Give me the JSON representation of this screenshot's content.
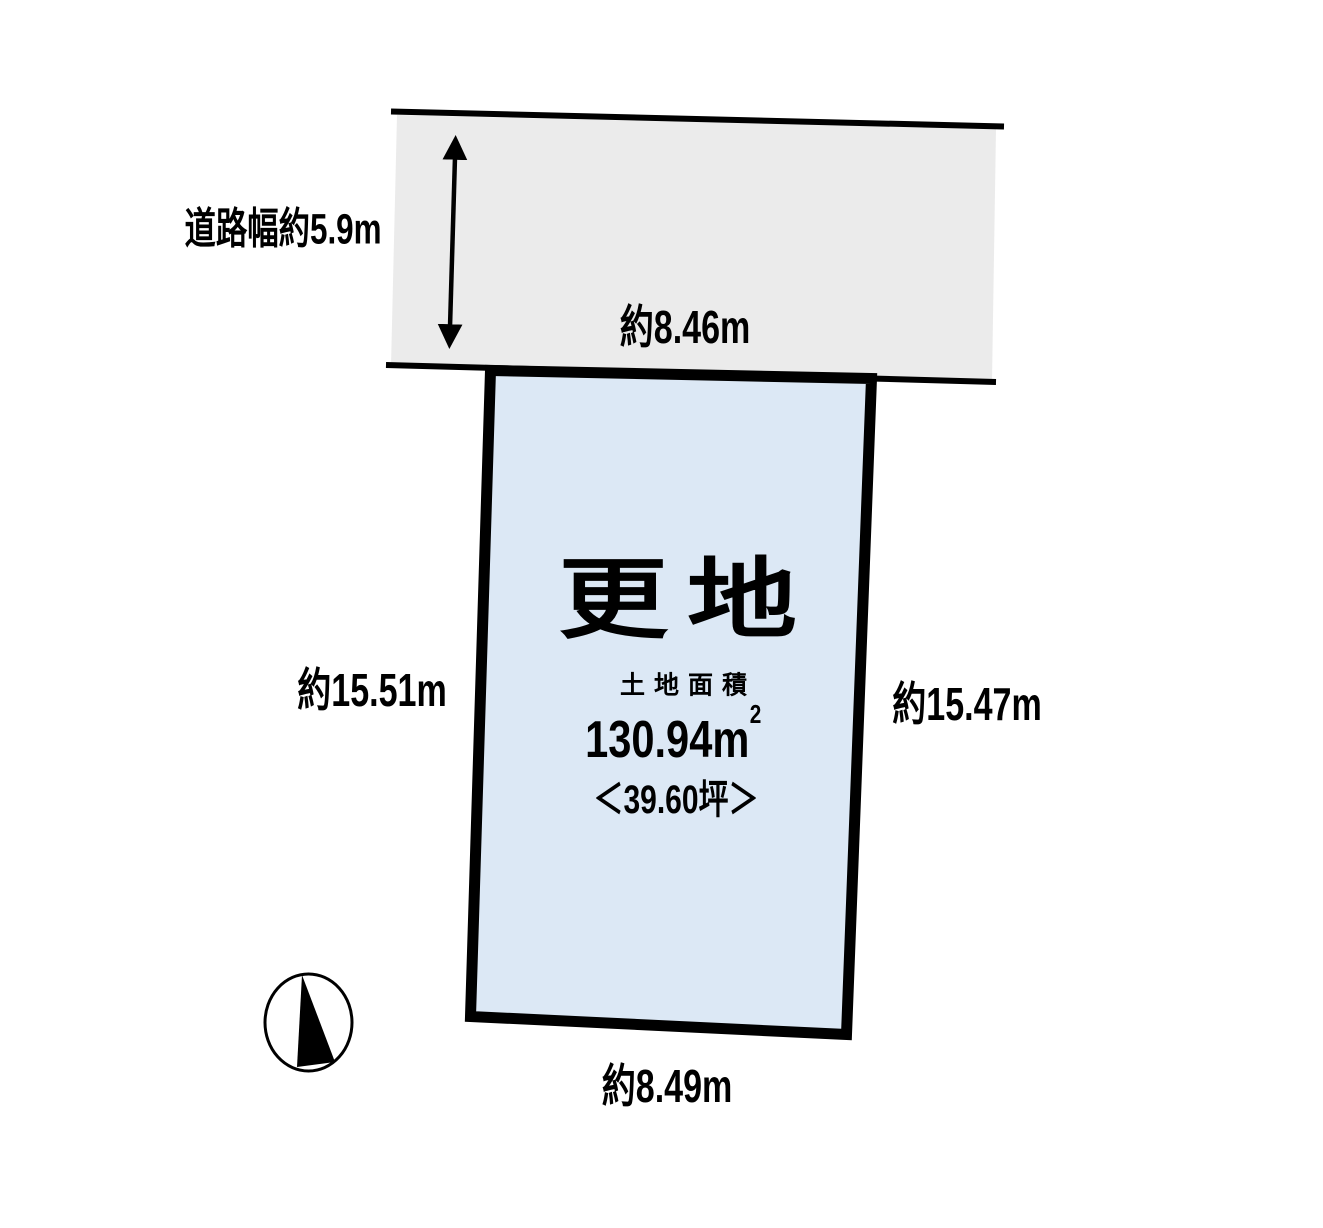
{
  "road": {
    "width_label": "道路幅約5.9m",
    "frontage_label": "約8.46m"
  },
  "plot": {
    "status_label": "更地",
    "area_caption": "土地面積",
    "area_value": "130.94m",
    "area_superscript": "2",
    "tsubo_label": "＜39.60坪＞",
    "side_left_label": "約15.51m",
    "side_right_label": "約15.47m",
    "side_bottom_label": "約8.49m"
  },
  "icons": {
    "compass": "north-arrow-compass-icon"
  },
  "colors": {
    "road_fill": "#ebebeb",
    "plot_fill": "#dce8f5",
    "line": "#000000",
    "text": "#000000",
    "background": "#ffffff"
  }
}
